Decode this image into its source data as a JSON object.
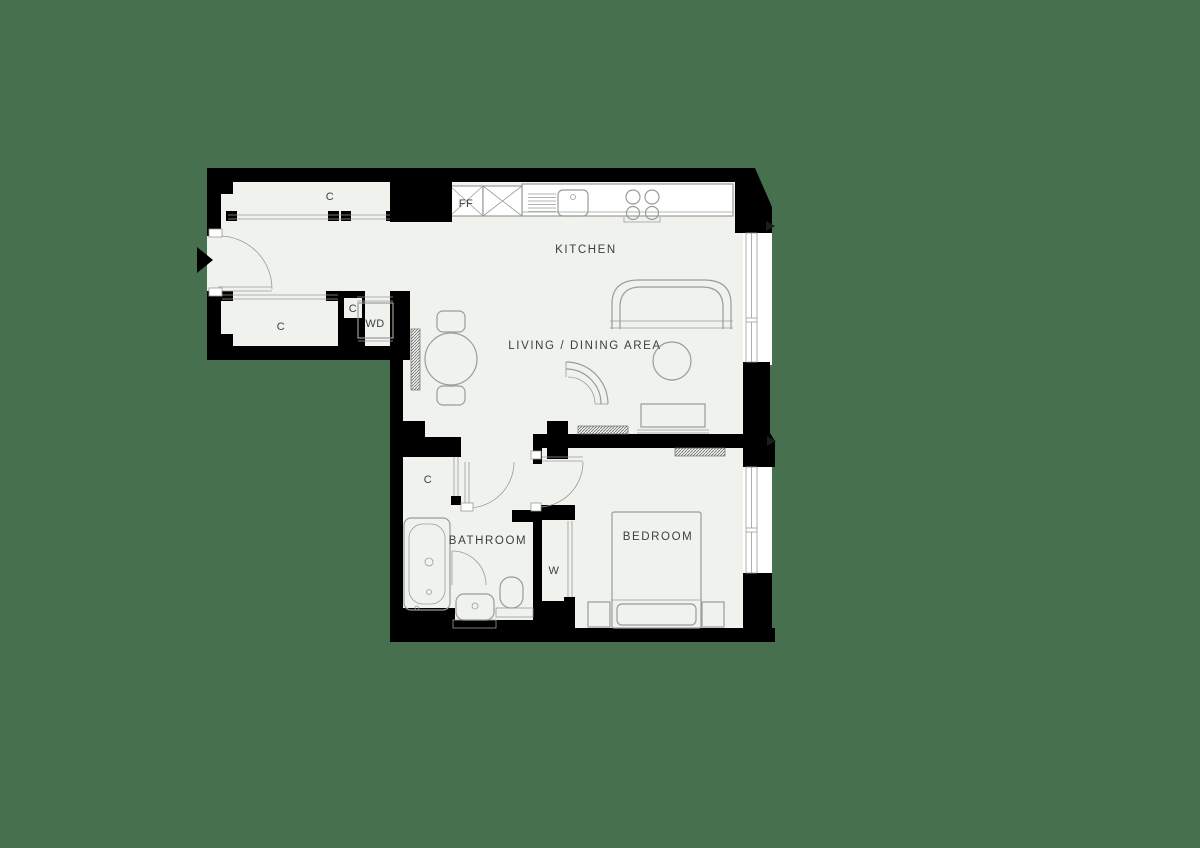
{
  "labels": {
    "kitchen": "KITCHEN",
    "living_dining": "LIVING / DINING AREA",
    "bathroom": "BATHROOM",
    "bedroom": "BEDROOM",
    "closet_hall_top": "C",
    "closet_hall_lower": "C",
    "closet_hall_small": "C",
    "closet_bathroom": "C",
    "wardrobe": "W",
    "washer_dryer": "WD",
    "fridge_freezer": "FF"
  },
  "colors": {
    "background": "#47714e",
    "walls": "#000000",
    "floor": "#f0f2ee",
    "furniture_line": "#989d98",
    "label_text": "#3c3f3c",
    "exterior": "#ffffff"
  }
}
